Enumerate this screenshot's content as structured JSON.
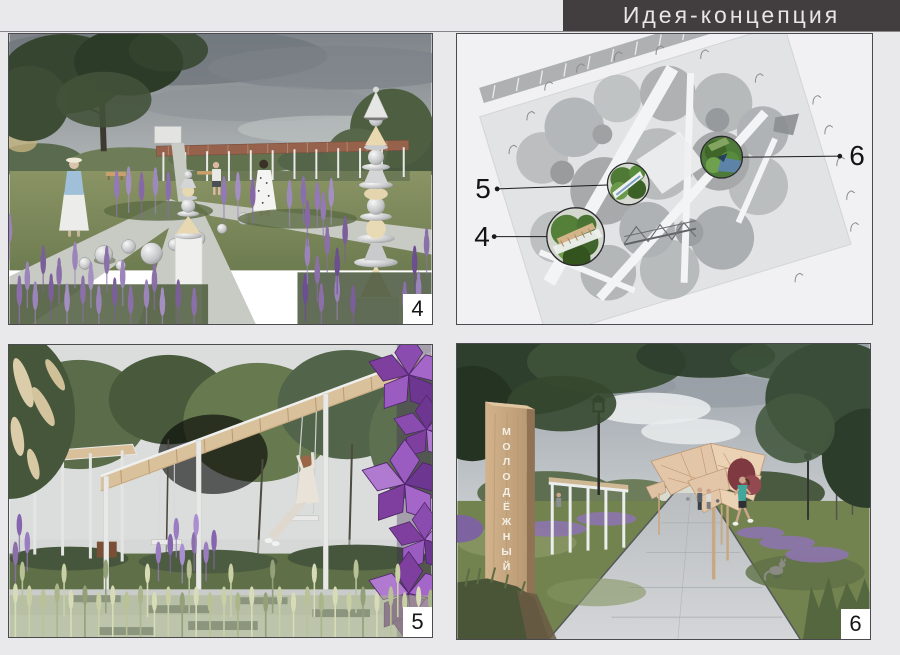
{
  "header": {
    "title": "Идея-концепция"
  },
  "plan": {
    "callouts": [
      {
        "label": "4"
      },
      {
        "label": "5"
      },
      {
        "label": "6"
      }
    ]
  },
  "panels": [
    {
      "number": "4"
    },
    {
      "number": "5"
    },
    {
      "number": "6",
      "sign_text": "МОЛОДЁЖНЫЙ"
    }
  ],
  "colors": {
    "page_bg": "#e9e9eb",
    "header_bg": "#423e3f",
    "header_text": "#e7e5e5",
    "panel_border": "#4b4b4f",
    "label_box_bg": "#ffffff",
    "accent_purple": "#8f76b4",
    "foliage_green": "#5c7047",
    "wood_tan": "#d9c19c",
    "callout_green": "#55803a"
  }
}
